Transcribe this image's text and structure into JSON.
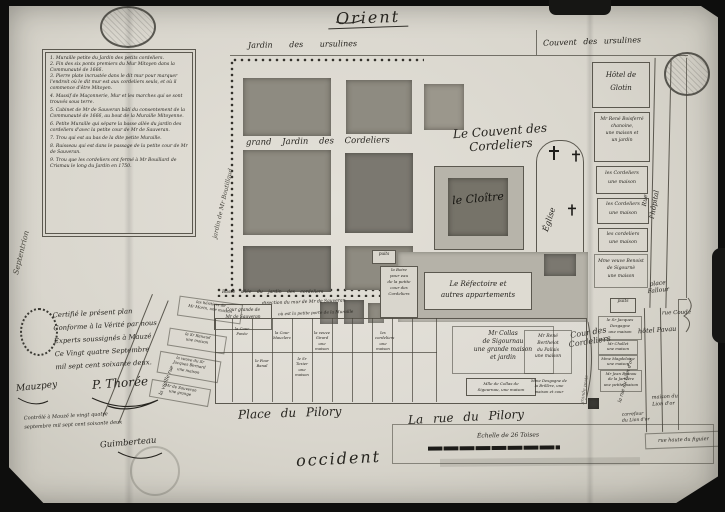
{
  "compass": {
    "east": "Orient",
    "west": "occident",
    "north": "Septentrion"
  },
  "surroundings": {
    "jardin_ursulines": "Jardin des ursulines",
    "couvent_ursulines": "Couvent des ursulines",
    "hotel_glotin": "Hôtel de\nGlotin",
    "jardin_boutillaud": "jardin de Mr Boutillaud",
    "hopital": "l'hôpital",
    "rue": "Rue"
  },
  "legend": {
    "items": [
      "1. Muraille petite du Jardin des petits cordeliers.",
      "2. Fin des six ponts premiers du Mur Mitoyen dans la Communauté de 1666.",
      "3. Pierre plate incrustée dans le dit mur pour marquer l'endroit où le dit mur est aux cordeliers seuls, et où il commence d'être Mitoyen.",
      "4. Massif de Maçonnerie, Mur et les marches qui se sont trouvés sous terre.",
      "5. Cabinet de Mr de Sauveran bâti du consentement de la Communauté de 1666, au bout de la Muraille Mitoyenne.",
      "6. Petite Muraille qui sépare la basse allée du jardin des cordeliers d'avec la petite cour de Mr de Sauveran.",
      "7. Trou qui est au bas de la dite petite Muraille.",
      "8. Ruisseau qui est dans le passage de la petite cour de Mr de Sauveran.",
      "9. Trou que les cordeliers ont fermé à Mr Bouillard de Crismau le long du Jardin en 1750."
    ]
  },
  "convent": {
    "title": "Le Couvent des\nCordeliers",
    "grand_jardin": "grand Jardin des Cordeliers",
    "cloitre": "le Cloître",
    "eglise": "Église",
    "refectoire": "Le Réfectoire et\nautres appartements",
    "cour": "Cour des\nCordeliers",
    "basse_allee": "Basse allée du jardin des cordeliers",
    "direction_mur": "direction du mur de Mr de Sauveran",
    "petite_porte": "où est la petite porte de la Muraille",
    "boire": "la Boire\npour eau\nde la petite\ncour des\nCordeliers",
    "puits_small": "puits"
  },
  "right": {
    "items": [
      "Mr René Boisferré\nchanoine,\nune maison et\nun jardin",
      "les Cordeliers\nune maison",
      "les Cordeliers\nune maison",
      "les cordeliers\nune maison",
      "Mme veuve Benoist\nde Sigournè\nune maison",
      "puits",
      "le Sr Jacques\nDesgagne\nune maison",
      "Mr Chollet\nune maison",
      "Mme Magdelaine\nune maison",
      "Mr Jean Brunau\nde la Jarillère\nune petite maison"
    ]
  },
  "places": {
    "place_fallour": "place\nFallour",
    "rue_coude": "rue Coudé",
    "hotel_pavau": "hôtel Pavau",
    "maison_lion": "maison du\nLion d'or",
    "carrefour_lion": "carrefour\ndu Lion d'or",
    "rue_figuier": "rue haute du figuier",
    "rue_lion": "la rue du Lion d'or",
    "grande_porte": "grande porte",
    "vieille_rue": "la vieille rue",
    "place_pilory": "Place du Pilory",
    "rue_pilory": "La rue du Pilory"
  },
  "parcels": {
    "cour_grande": "Cour grande de\nMr de Sauveran",
    "collas": "Mr Collas\nde Sigournau\nune grande maison\net jardin",
    "collas_fille": "Mlle de Collas de\nSigournau, une maison",
    "berthelot": "Mr René\nBerthelot\ndu Pallais\nune maison",
    "desgagne_brillere": "Mme Desgagne de\nla Brillère, une\nmaison et cour",
    "cour_pavee": "la Cour\nPavée",
    "four_banal": "le Four\nBanal",
    "cour_mauclerc": "la Cour\nMauclerc",
    "texier": "le Sr\nTexier\nune\nmaison",
    "girard": "la veuve\nGirard\nune\nmaison",
    "cordeliers_m": "les\ncordeliers\nune\nmaison",
    "heritiers_morin": "les héritiers de\nMr Morin, une maison",
    "renaud": "le Sr Renaud\nune maison",
    "veuve_bernard": "la veuve du Sr\nJacques Bernard\nune maison",
    "sauveran_grange": "Mr de Sauveran\nune grange"
  },
  "certificate": {
    "line1": "Certifié le présent plan",
    "line2": "Conforme à la Vérité par nous",
    "line3": "Experts soussignés à Mauzé",
    "line4": "Ce Vingt quatre Septembre",
    "line5": "mil sept cent soixante deux.",
    "sig1": "Mauzpey",
    "sig2": "P. Thorée",
    "control": "Contrôlé à Mauzé le vingt quatre\nseptembre mil sept cent soixante deux",
    "sig3": "Guimberteau"
  },
  "scale": {
    "label": "Échelle de 26 Toises"
  }
}
